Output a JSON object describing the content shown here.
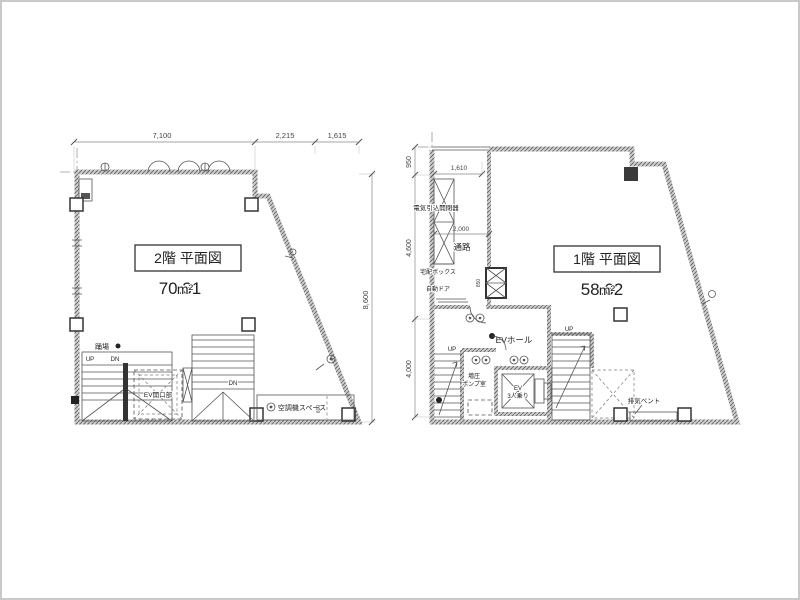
{
  "drawing": {
    "floor2": {
      "title": "2階 平面図",
      "area": "70.31",
      "unit": "m²",
      "dim_top_1": "7,100",
      "dim_top_2": "2,215",
      "dim_top_3": "1,615",
      "dim_right": "8,600",
      "dim_small": "600",
      "label_landing": "踊場",
      "label_up": "UP",
      "label_dn": "DN",
      "label_dn2": "DN",
      "label_ev_opening": "EV開口部",
      "label_ac_space": "空調機スペース"
    },
    "floor1": {
      "title": "1階 平面図",
      "area": "58.62",
      "unit": "m²",
      "dim_left_1": "950",
      "dim_left_2": "4,600",
      "dim_left_3": "4,000",
      "dim_inner_1": "1,610",
      "dim_inner_2": "2,000",
      "dim_small": "850",
      "label_electric": "電気引込開閉器",
      "label_corridor": "通路",
      "label_delivery": "宅配ボックス",
      "label_autodoor": "自動ドア",
      "label_evhall": "EVホール",
      "label_up1": "UP",
      "label_up2": "UP",
      "label_pump_1": "増圧",
      "label_pump_2": "ポンプ室",
      "label_ev": "EV",
      "label_ev_cap": "3人乗り",
      "label_vent": "排気ベント"
    },
    "colors": {
      "wall_gray": "#8a8a8a",
      "line": "#444444",
      "background": "#ffffff"
    }
  }
}
